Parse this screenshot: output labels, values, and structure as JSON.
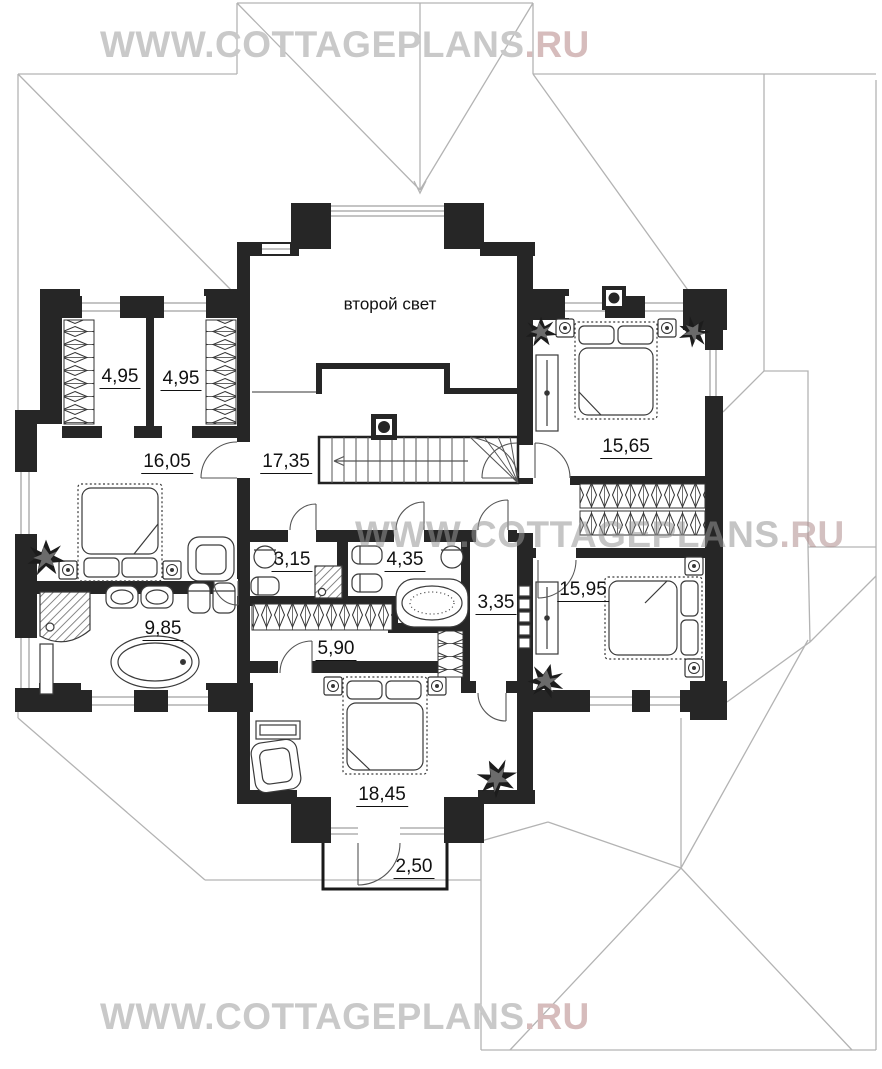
{
  "watermarks": {
    "top": {
      "text": "WWW.COTTAGEPLANS",
      "suffix": ".RU"
    },
    "middle": {
      "text": "WWW.COTTAGEPLANS",
      "suffix": ".RU"
    },
    "bottom": {
      "text": "WWW.COTTAGEPLANS",
      "suffix": ".RU"
    }
  },
  "plan": {
    "second_light_label": "второй свет",
    "rooms": {
      "hall": "17,35",
      "closet_a": "4,95",
      "closet_b": "4,95",
      "bedroom_left": "16,05",
      "bedroom_top_right": "15,65",
      "wc_small": "3,15",
      "bathroom_center": "4,35",
      "hallway": "3,35",
      "bedroom_right": "15,95",
      "bathroom_master": "9,85",
      "wardrobe": "5,90",
      "bedroom_bottom": "18,45",
      "balcony": "2,50"
    }
  },
  "colors": {
    "wall": "#262626",
    "roof_line": "#b3b3b3",
    "watermark": "#c9c9c9",
    "watermark_ru": "#d6bcbc",
    "label": "#111111"
  }
}
